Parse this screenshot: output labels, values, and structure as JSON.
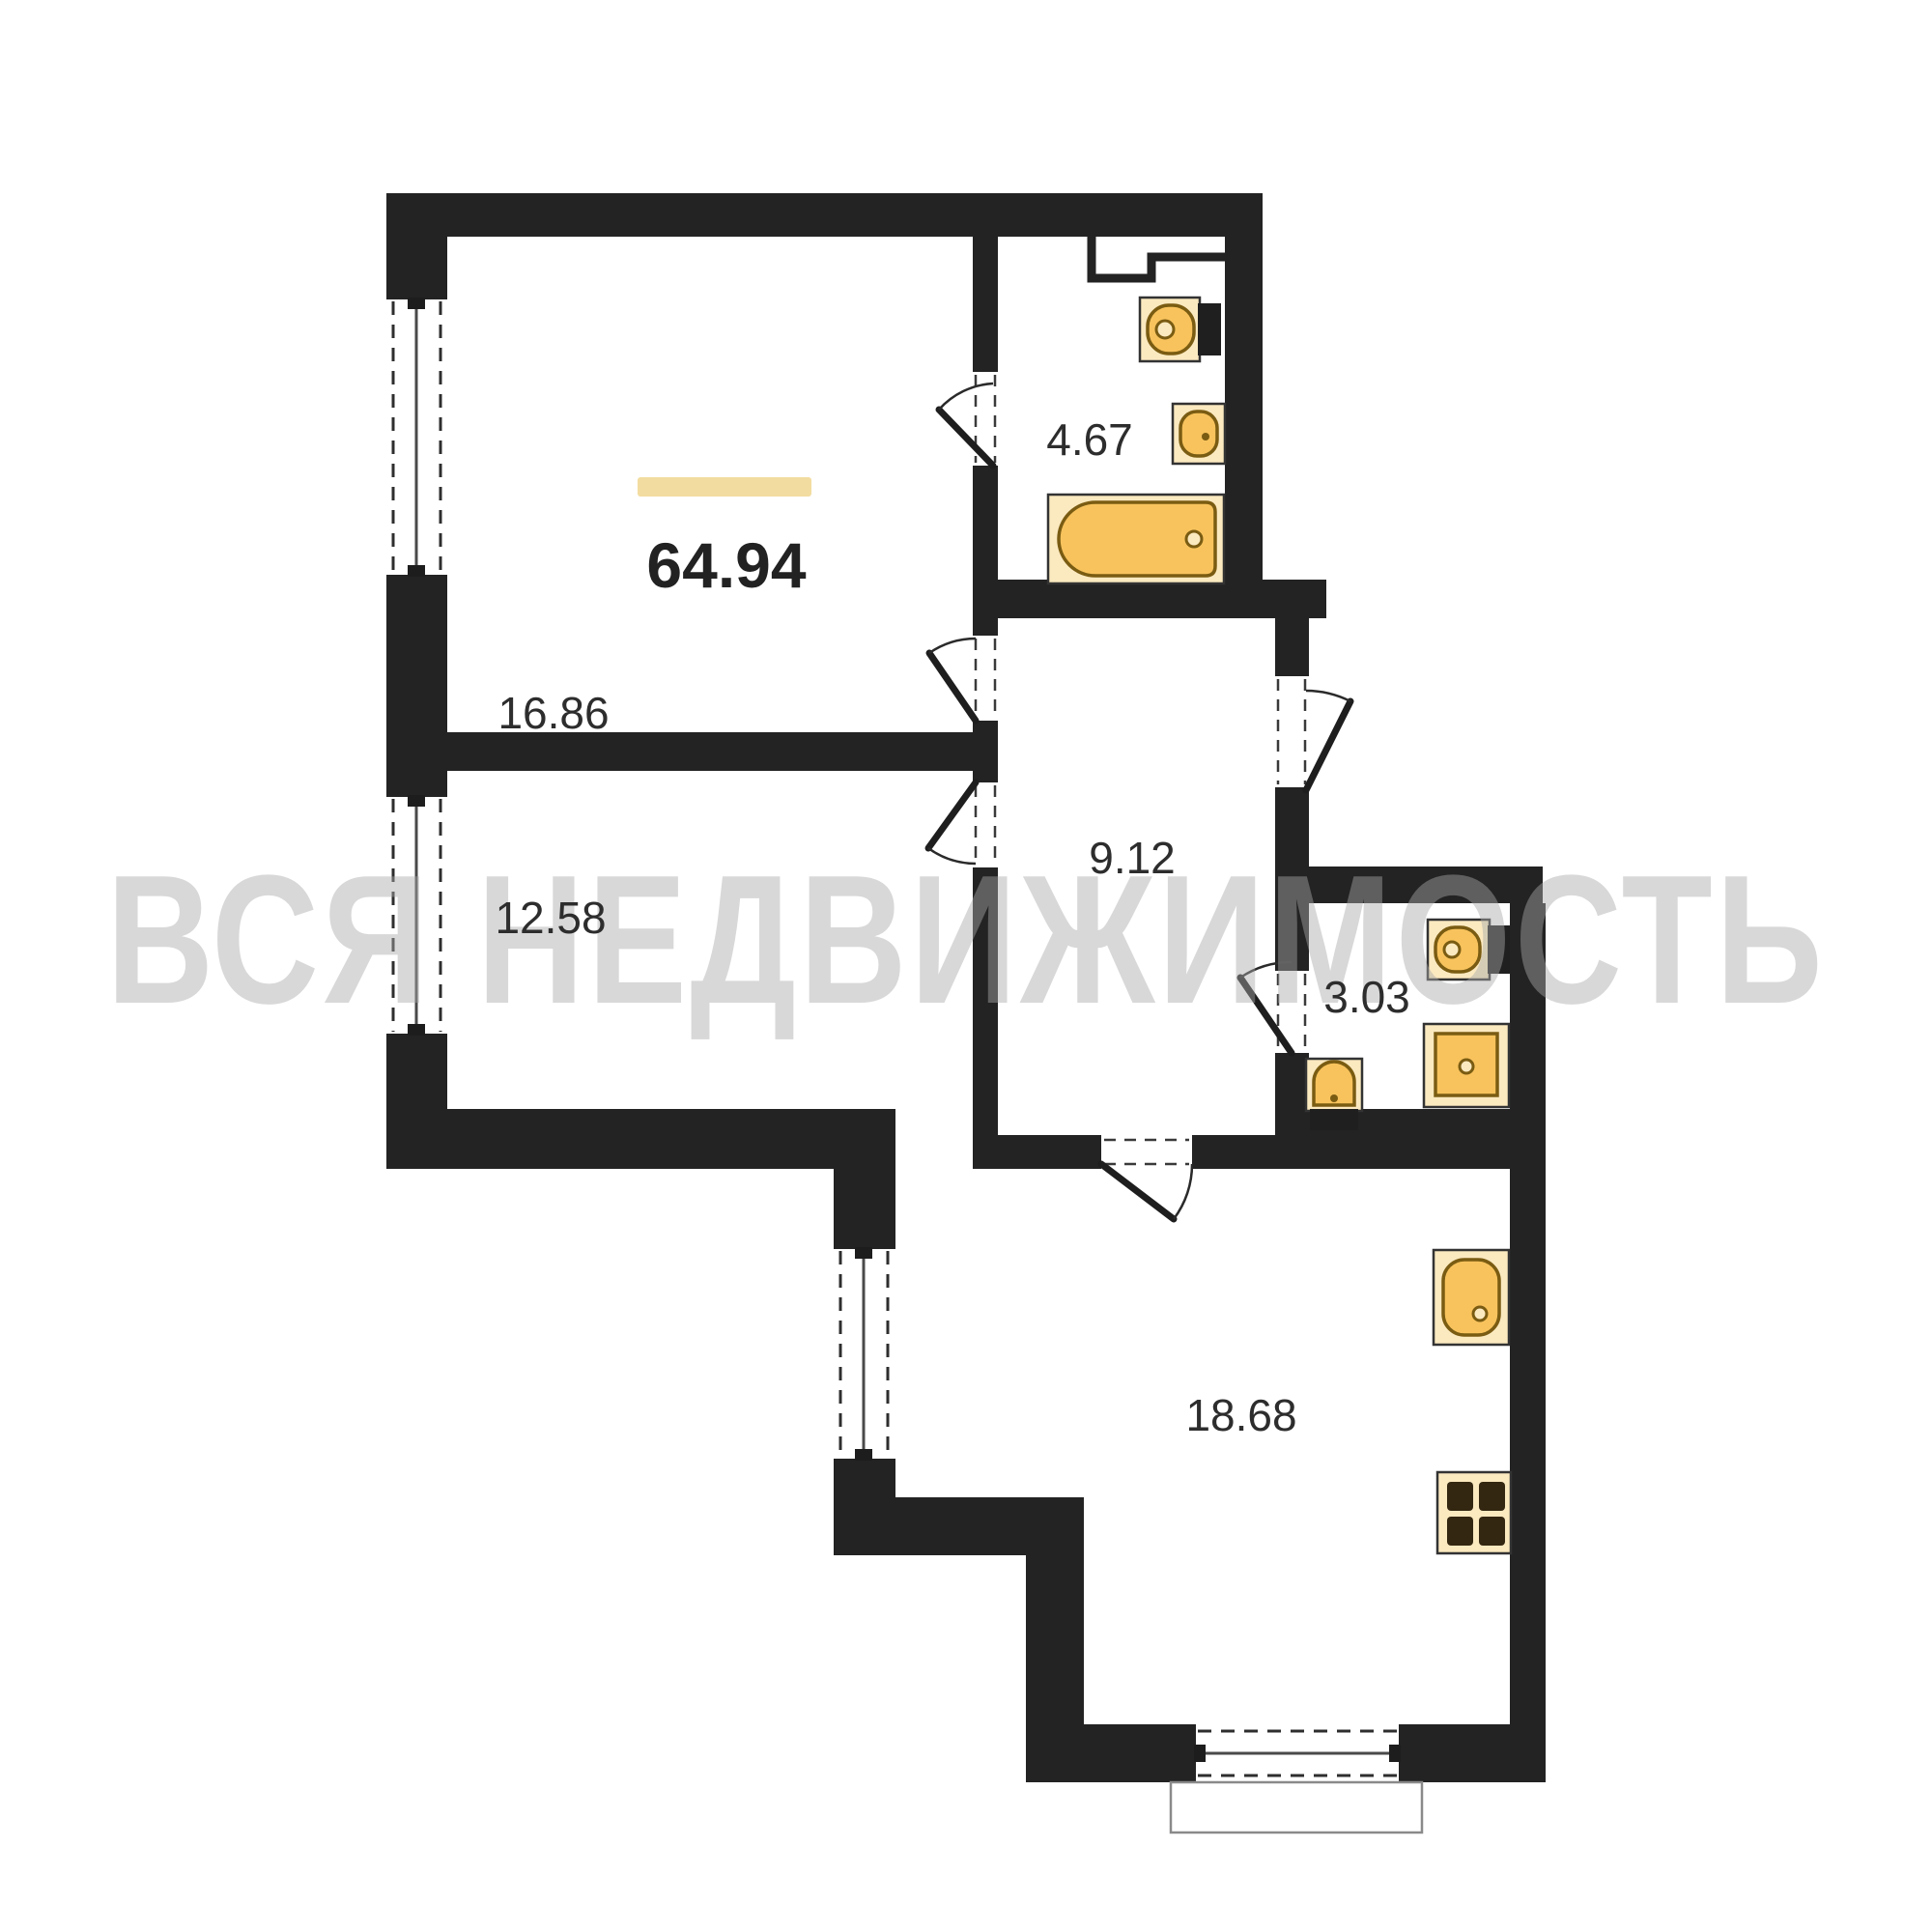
{
  "plan": {
    "type": "apartment-floor-plan",
    "total_area": "64.94",
    "watermark": "ВСЯ НЕДВИЖИМОСТЬ",
    "rooms": [
      {
        "name": "living-room",
        "area": "16.86"
      },
      {
        "name": "bedroom",
        "area": "12.58"
      },
      {
        "name": "hallway",
        "area": "9.12"
      },
      {
        "name": "bathroom",
        "area": "4.67"
      },
      {
        "name": "wc",
        "area": "3.03"
      },
      {
        "name": "kitchen-living",
        "area": "18.68"
      }
    ],
    "fixtures": [
      {
        "room": "bathroom",
        "items": [
          "toilet",
          "washbasin",
          "bathtub"
        ]
      },
      {
        "room": "wc",
        "items": [
          "toilet",
          "washbasin",
          "shower-tray"
        ]
      },
      {
        "room": "kitchen-living",
        "items": [
          "kitchen-sink",
          "stove-4-burner"
        ]
      }
    ],
    "windows_count": 4,
    "colors": {
      "wall": "#232323",
      "fixture_body": "#F8C35D",
      "fixture_frame": "#FBE9C0",
      "fixture_stroke": "#7a5c12",
      "accent_bar": "#F2DCA0",
      "label": "#2d2d2d",
      "watermark": "#a9a9a9"
    }
  }
}
